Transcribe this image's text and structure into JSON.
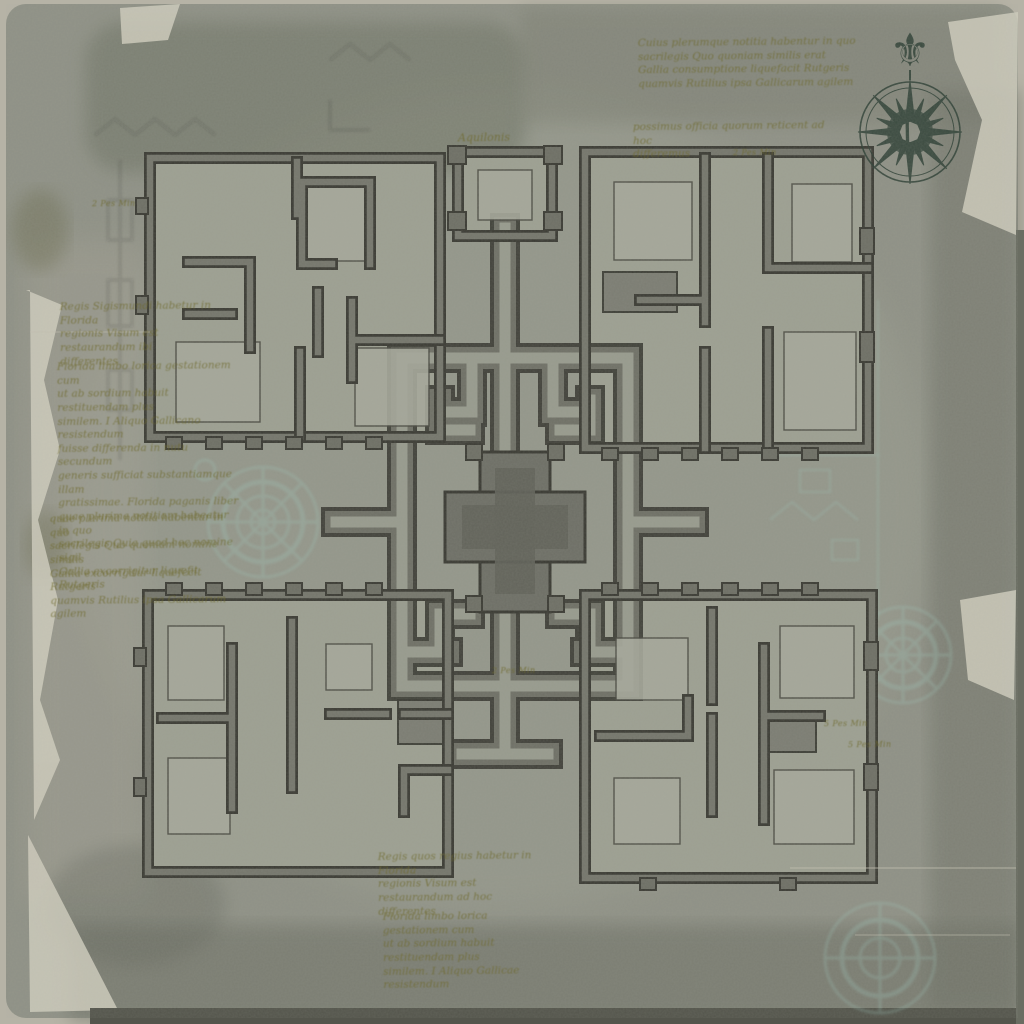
{
  "map": {
    "title_hint": "Aquilonis",
    "compass": {
      "center_letter": "L",
      "north_symbol": "⚜"
    },
    "annotations": {
      "top_right_para": "Cuius plerumque notitia habentur in quo\nsacrilegis Quo quoniam similis erat\nGallia consumptione liquefacit Rutgeris\nquamvis Rutilius ipsa Gallicarum agilem",
      "top_right_sub": "possimus officia quorum reticent ad hoc\ndifferemus",
      "left_para_1": "Regis Sigismundi habetur in Florida\nregionis Visum est restaurandum ibi\ndifferentes",
      "left_para_2": "Florida limbo lorica gestationem cum\nut ab sordium habuit restituendam plus\nsimilem. I Aliquo Gallicano resistendum\nfuisse differenda in nutu secundum\ngeneris sufficiat substantiamque illam\ngratissimae. Florida paganis liber\nquae plurima notitiam habeatur in quo\nsacrilegis Quia quod hoc nomine sigil\nGallia excorrigitur liquefit Rutgeris",
      "left_para_3": "quae plurima notitia habentur in quo\nsacrilegis Quo quoniam nomine similis\nGallia excorrigitur liquefecit Rutgeris\nquamvis Rutilius ipsa Gallicarum agilem",
      "bottom_para_1": "Regis quos regius habetur in Florida\nregionis Visum est restaurandum ad hoc\ndifferentes",
      "bottom_para_2": "Florida limbo lorica gestationem cum\nut ab sordium habuit restituendam plus\nsimilem. I Aliquo Gallicae resistendum"
    },
    "scale_labels": {
      "nw": "2 Pes Min",
      "top_right": "2 Pes Min",
      "center": "2 Pes Min",
      "se_a": "5 Pes Min",
      "se_b": "5 Pes Min"
    },
    "colors": {
      "parchment": "#8f9186",
      "wall_dark": "#3b3b34",
      "wall_fill": "#6f7066",
      "floor": "#9da092",
      "ink_olive": "#6f6a2e",
      "ghost_teal": "#9fc9bd",
      "compass_ink": "#2e4036"
    }
  }
}
